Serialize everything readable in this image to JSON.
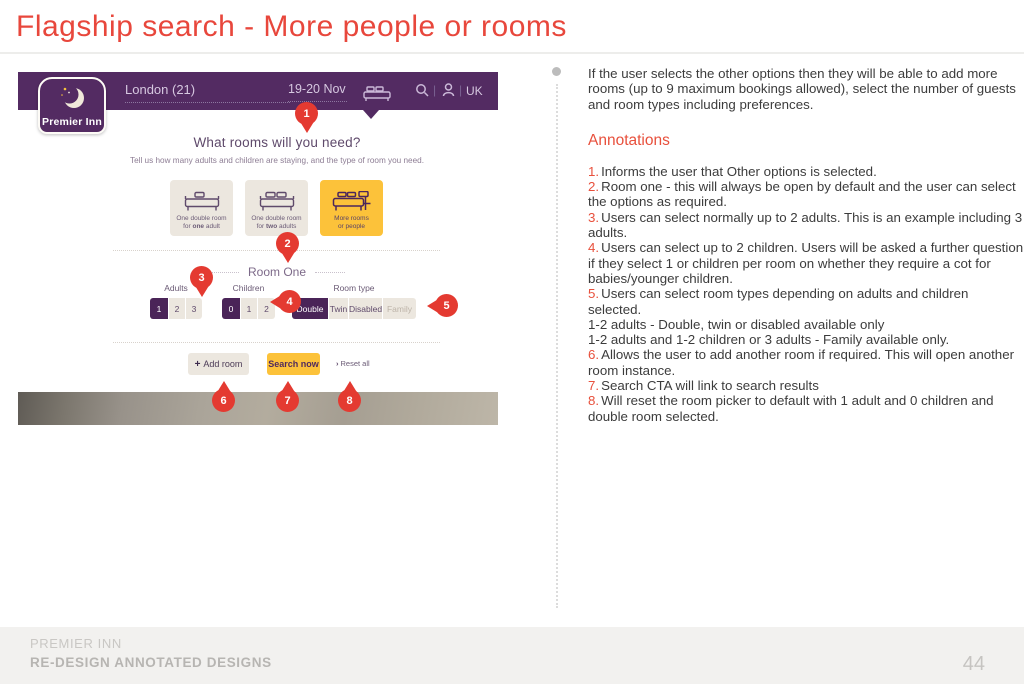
{
  "page": {
    "title": "Flagship search - More people or rooms",
    "footer": {
      "brand": "PREMIER INN",
      "subtitle": "RE-DESIGN ANNOTATED DESIGNS",
      "page_number": "44"
    }
  },
  "colors": {
    "brand_purple": "#532b62",
    "selected_purple": "#4a2458",
    "brand_yellow": "#fcc23a",
    "accent_red": "#e8473c",
    "marker_red": "#e43a31",
    "card_beige": "#ece7df",
    "footer_gray": "#f2f1ef"
  },
  "icons": {
    "logo": "crescent-moon-with-stars",
    "rooms_menu": "double-bed",
    "search": "magnifier",
    "account": "person",
    "add_room_plus": "+",
    "reset_chevron": "›",
    "intro_bullet": "•"
  },
  "mockup": {
    "header": {
      "logo": "Premier Inn",
      "location": "London (21)",
      "dates": "19-20 Nov",
      "country": "UK",
      "divider": "|"
    },
    "heading": "What rooms will you need?",
    "subheading": "Tell us how many adults and children are staying, and the type of room you need.",
    "occupancy_cards": [
      {
        "top": "One double room",
        "pre": "for ",
        "bold": "one",
        "post": " adult"
      },
      {
        "top": "One double room",
        "pre": "for ",
        "bold": "two",
        "post": " adults"
      },
      {
        "top": "More rooms",
        "pre": "",
        "bold": "",
        "post": "or people"
      }
    ],
    "room_one": {
      "title": "Room One",
      "adults": {
        "label": "Adults",
        "options": [
          "1",
          "2",
          "3"
        ],
        "selected": "1"
      },
      "children": {
        "label": "Children",
        "options": [
          "0",
          "1",
          "2"
        ],
        "selected": "0"
      },
      "room_type": {
        "label": "Room type",
        "options": [
          "Double",
          "Twin",
          "Disabled",
          "Family"
        ],
        "selected": "Double",
        "disabled_option": "Family"
      }
    },
    "actions": {
      "add_room": "Add room",
      "search": "Search now",
      "reset": "Reset all"
    },
    "markers": [
      "1",
      "2",
      "3",
      "4",
      "5",
      "6",
      "7",
      "8"
    ]
  },
  "annotations_panel": {
    "intro": "If the user selects the other options then they will be able to add more rooms (up to 9 maximum bookings allowed), select the number of guests and room types including preferences.",
    "heading": "Annotations",
    "items": [
      {
        "num": "1.",
        "text": "Informs the user that Other options is selected."
      },
      {
        "num": "2.",
        "text": "Room one - this will always be open by default and the user can select the options as required."
      },
      {
        "num": "3.",
        "text": "Users can select normally up to 2 adults.  This is an example including 3 adults."
      },
      {
        "num": "4.",
        "text": "Users can select up to 2 children.  Users will be asked a further question if they select 1 or children per room on whether they require a cot for babies/younger children."
      },
      {
        "num": "5.",
        "text": "Users can select room types depending on adults and children selected."
      },
      {
        "num": "",
        "text": "1-2 adults - Double, twin or disabled available only"
      },
      {
        "num": "",
        "text": "1-2 adults and 1-2 children or 3 adults - Family available only."
      },
      {
        "num": "6.",
        "text": "Allows the user to add another room if required.  This will open another room instance."
      },
      {
        "num": "7.",
        "text": "Search CTA will link to search results"
      },
      {
        "num": "8.",
        "text": "Will reset the room picker to default with 1 adult and 0 children and double room selected."
      }
    ]
  }
}
